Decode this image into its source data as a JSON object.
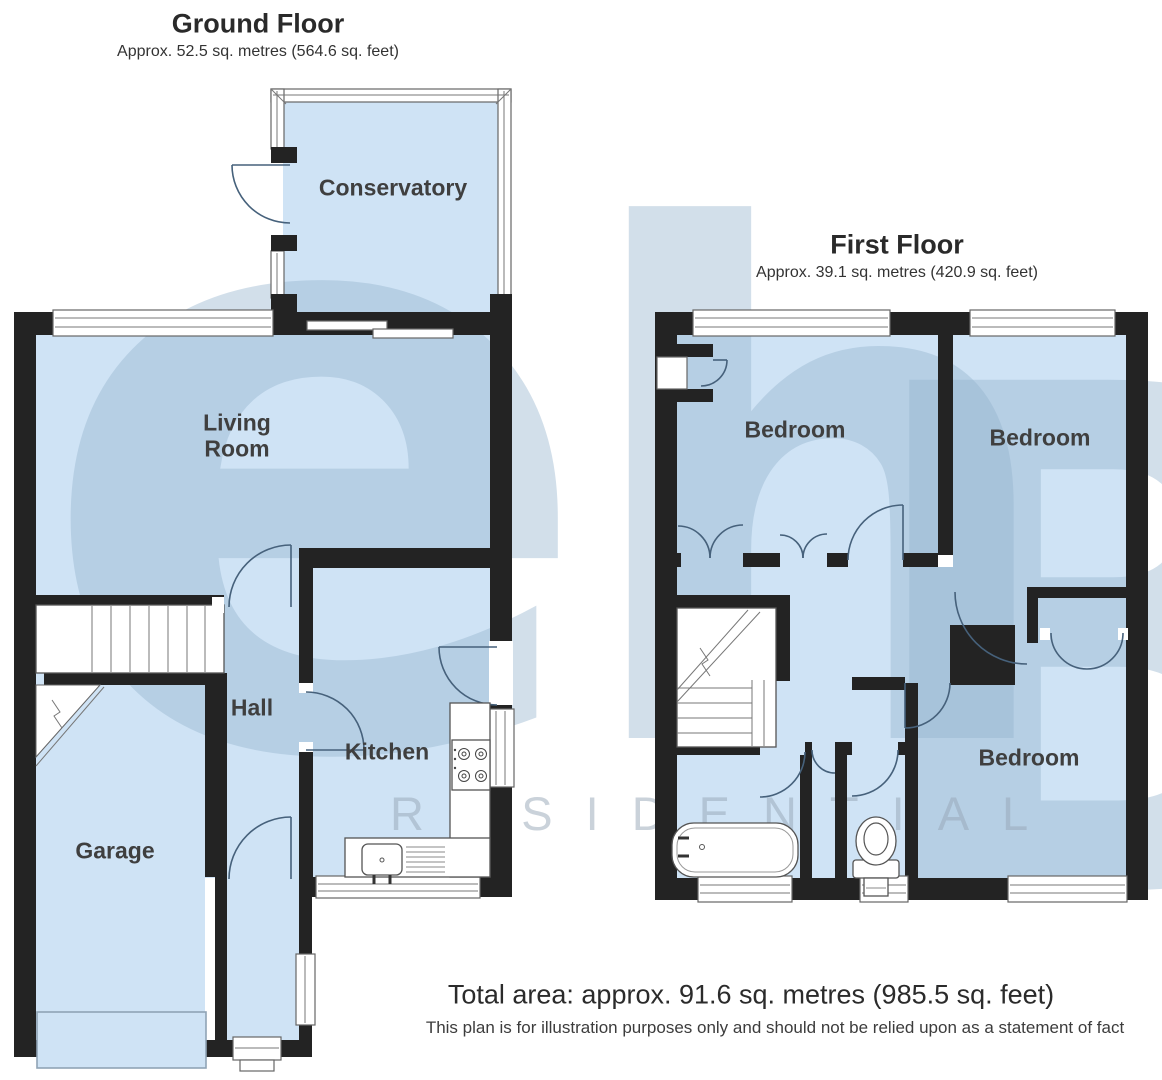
{
  "ground_floor": {
    "title": "Ground Floor",
    "subtitle": "Approx. 52.5 sq. metres (564.6 sq. feet)",
    "rooms": {
      "conservatory": "Conservatory",
      "living_room": "Living Room",
      "hall": "Hall",
      "kitchen": "Kitchen",
      "garage": "Garage"
    }
  },
  "first_floor": {
    "title": "First Floor",
    "subtitle": "Approx. 39.1 sq. metres (420.9 sq. feet)",
    "rooms": {
      "bedroom1": "Bedroom",
      "bedroom2": "Bedroom",
      "bedroom3": "Bedroom"
    }
  },
  "watermark": {
    "letters": [
      "e",
      "h",
      "B"
    ],
    "tagline": "RESIDENTIAL"
  },
  "footer": {
    "total_area": "Total area: approx. 91.6 sq. metres (985.5 sq. feet)",
    "disclaimer": "This plan is for illustration purposes only and should not be relied upon as a statement of fact"
  },
  "colors": {
    "room_fill": "#cfe3f5",
    "wall": "#232323",
    "watermark_blue": "#b9cfe2",
    "label": "#3f3f3f"
  }
}
